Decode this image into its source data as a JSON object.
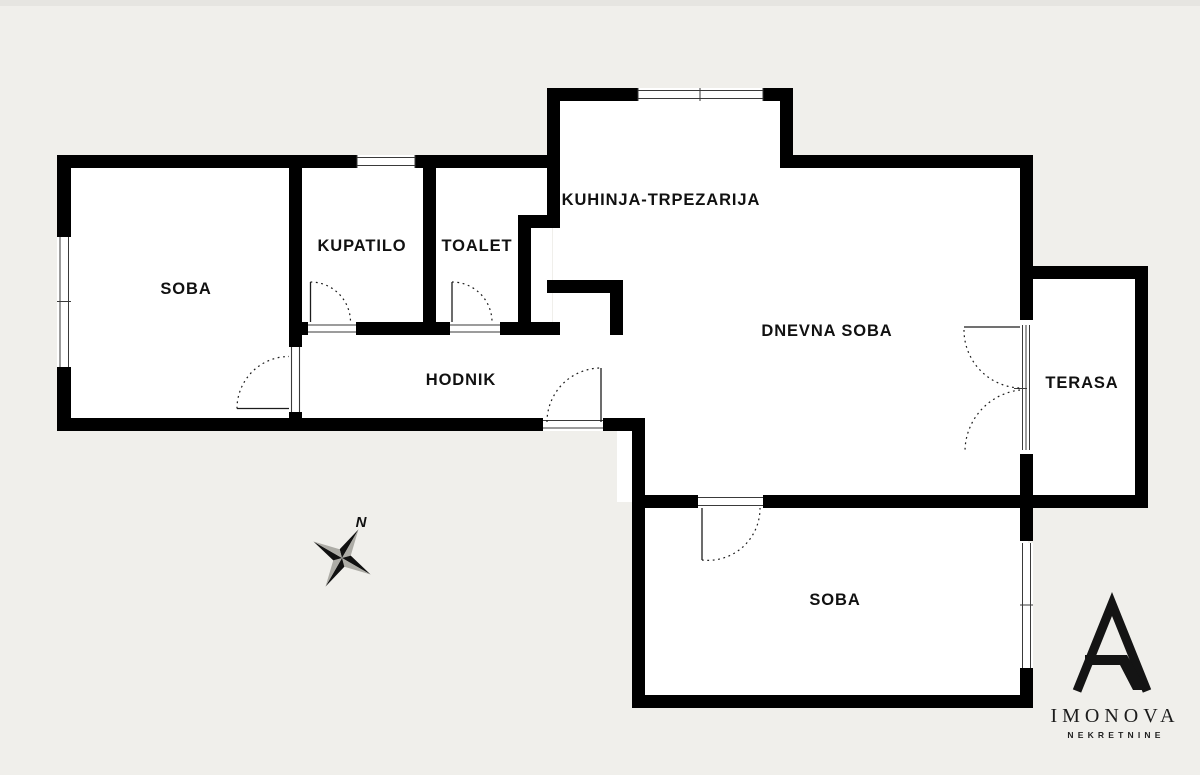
{
  "colors": {
    "background": "#f0efeb",
    "top_strip": "#e6e5e1",
    "wall": "#000000",
    "floor": "#ffffff",
    "thin_line": "#3a3a3a",
    "compass_dark": "#111111",
    "compass_light": "#adaca6",
    "logo_ink": "#141414"
  },
  "rooms": {
    "soba_left": {
      "label": "SOBA"
    },
    "kupatilo": {
      "label": "KUPATILO"
    },
    "toalet": {
      "label": "TOALET"
    },
    "kuhinja": {
      "label": "KUHINJA-TRPEZARIJA"
    },
    "dnevna_soba": {
      "label": "DNEVNA SOBA"
    },
    "hodnik": {
      "label": "HODNIK"
    },
    "terasa": {
      "label": "TERASA"
    },
    "soba_bottom": {
      "label": "SOBA"
    }
  },
  "compass": {
    "north_label": "N"
  },
  "logo": {
    "brand": "IMONOVA",
    "tagline": "NEKRETNINE"
  }
}
